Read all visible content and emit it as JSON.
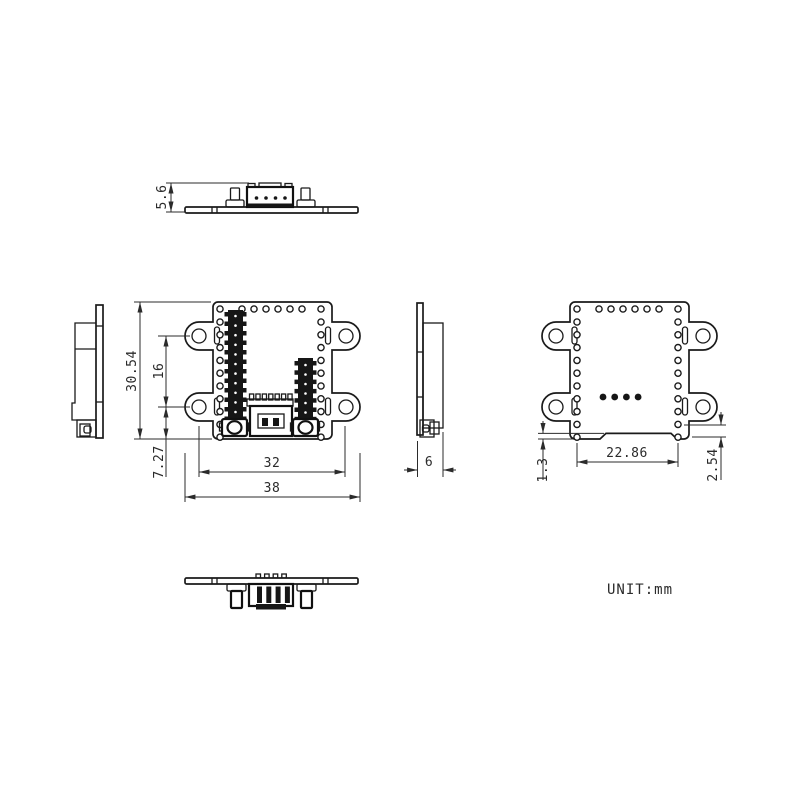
{
  "unit_label": "UNIT:mm",
  "dimensions": {
    "profile_height": "5.6",
    "overall_height": "30.54",
    "hole_spacing_vertical": "16",
    "hole_bottom_offset": "7.27",
    "hole_spacing_horizontal": "32",
    "overall_width": "38",
    "thickness": "6",
    "connector_span": "22.86",
    "notch_depth": "1.3",
    "pad_pitch": "2.54"
  }
}
